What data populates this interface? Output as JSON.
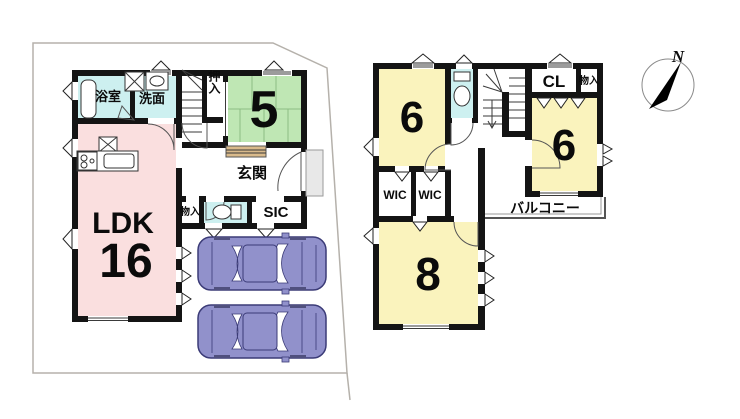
{
  "compass": {
    "north_label": "N"
  },
  "floor1": {
    "bathroom": "浴室",
    "washroom": "洗面",
    "oshiire_closet": "押入",
    "tatami_room_size": "5",
    "entrance": "玄関",
    "storage": "物入",
    "shoe_in_closet": "SIC",
    "living_label": "LDK",
    "living_size": "16"
  },
  "floor2": {
    "bedroom_left_size": "6",
    "closet": "CL",
    "storage": "物入",
    "bedroom_right_size": "6",
    "wic_left": "WIC",
    "wic_right": "WIC",
    "balcony": "バルコニー",
    "bedroom_bottom_size": "8"
  },
  "colors": {
    "wall": "#141414",
    "tatami_green": "#bfe7b4",
    "ldk_pink": "#fadfdf",
    "bedroom_yellow": "#faf3bd",
    "water_cyan": "#cdf0f0",
    "bathtub_cyan": "#7fe2e6",
    "car_purple": "#9191cb",
    "entrance_step_tan": "#d9ba8b",
    "porch_gray": "#e8e8e8",
    "boundary_gray": "#b5b1ab"
  }
}
